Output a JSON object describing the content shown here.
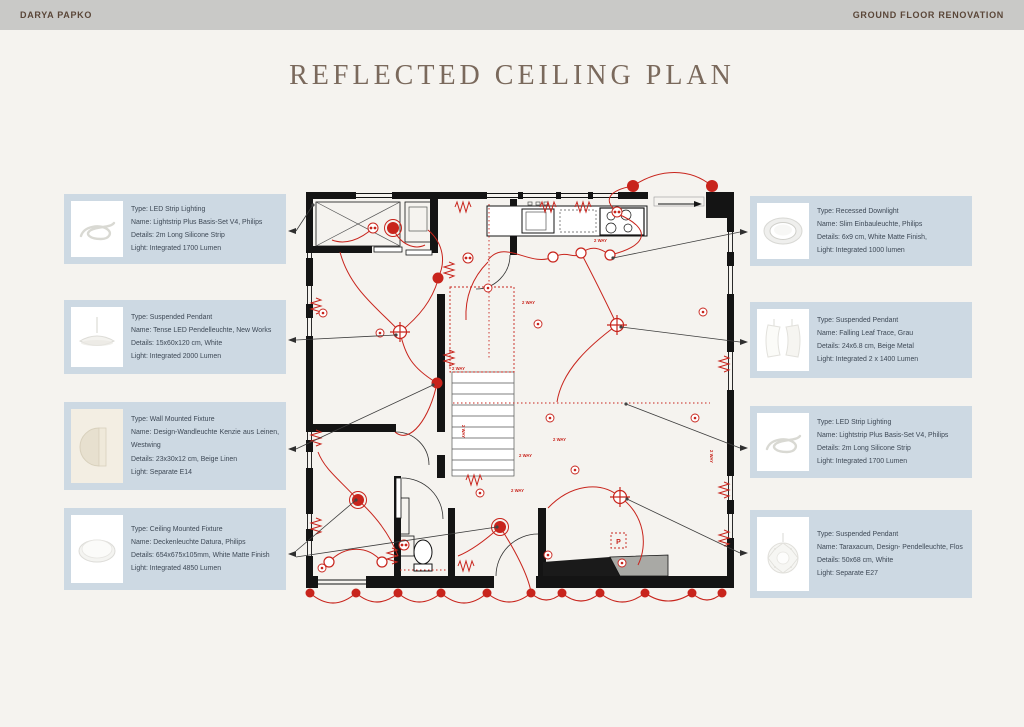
{
  "header": {
    "left": "DARYA PAPKO",
    "right": "GROUND FLOOR RENOVATION"
  },
  "title": "REFLECTED CEILING PLAN",
  "colors": {
    "accent_red": "#c8241c",
    "card_background": "#cdd9e3",
    "topbar_background": "#c9c9c7",
    "title_color": "#7a695c",
    "card_text": "#3e4956",
    "page_background": "#f5f3ef"
  },
  "fixtures": {
    "left": [
      {
        "icon": "led-strip-icon",
        "type": "Type: LED Strip Lighting",
        "name": "Name: Lightstrip Plus Basis-Set V4, Philips",
        "details": "Details: 2m Long Silicone Strip",
        "light": "Light: Integrated 1700 Lumen"
      },
      {
        "icon": "suspended-pendant-tense-icon",
        "type": "Type: Suspended Pendant",
        "name": "Name: Tense LED Pendelleuchte, New Works",
        "details": "Details: 15x60x120 cm, White",
        "light": "Light: Integrated 2000 Lumen"
      },
      {
        "icon": "wall-mounted-kenzie-icon",
        "type": "Type: Wall Mounted Fixture",
        "name": "Name: Design-Wandleuchte Kenzie aus Leinen, Westwing",
        "details": "Details: 23x30x12 cm, Beige Linen",
        "light": "Light: Separate E14"
      },
      {
        "icon": "ceiling-mounted-datura-icon",
        "type": "Type: Ceiling Mounted Fixture",
        "name": "Name: Deckenleuchte Datura, Philips",
        "details": "Details: 654x675x105mm, White Matte Finish",
        "light": "Light: Integrated 4850 Lumen"
      }
    ],
    "right": [
      {
        "icon": "recessed-downlight-icon",
        "type": "Type: Recessed Downlight",
        "name": "Name: Slim Einbauleuchte, Philips",
        "details": "Details: 6x9 cm, White Matte Finish,",
        "light": "Light: Integrated 1000 lumen"
      },
      {
        "icon": "suspended-pendant-falling-leaf-icon",
        "type": "Type: Suspended Pendant",
        "name": "Name: Falling Leaf Trace, Grau",
        "details": "Details: 24x6.8 cm, Beige Metal",
        "light": "Light: Integrated 2 x 1400 Lumen"
      },
      {
        "icon": "led-strip-icon",
        "type": "Type: LED Strip Lighting",
        "name": "Name: Lightstrip Plus Basis-Set V4, Philips",
        "details": "Details: 2m Long Silicone Strip",
        "light": "Light: Integrated 1700 Lumen"
      },
      {
        "icon": "suspended-pendant-taraxacum-icon",
        "type": "Type: Suspended Pendant",
        "name": "Name: Taraxacum, Design- Pendelleuchte, Flos",
        "details": "Details: 50x68 cm, White",
        "light": "Light: Separate E27"
      }
    ]
  },
  "plan": {
    "labels": {
      "two_way": "2 WAY",
      "p": "P"
    }
  }
}
